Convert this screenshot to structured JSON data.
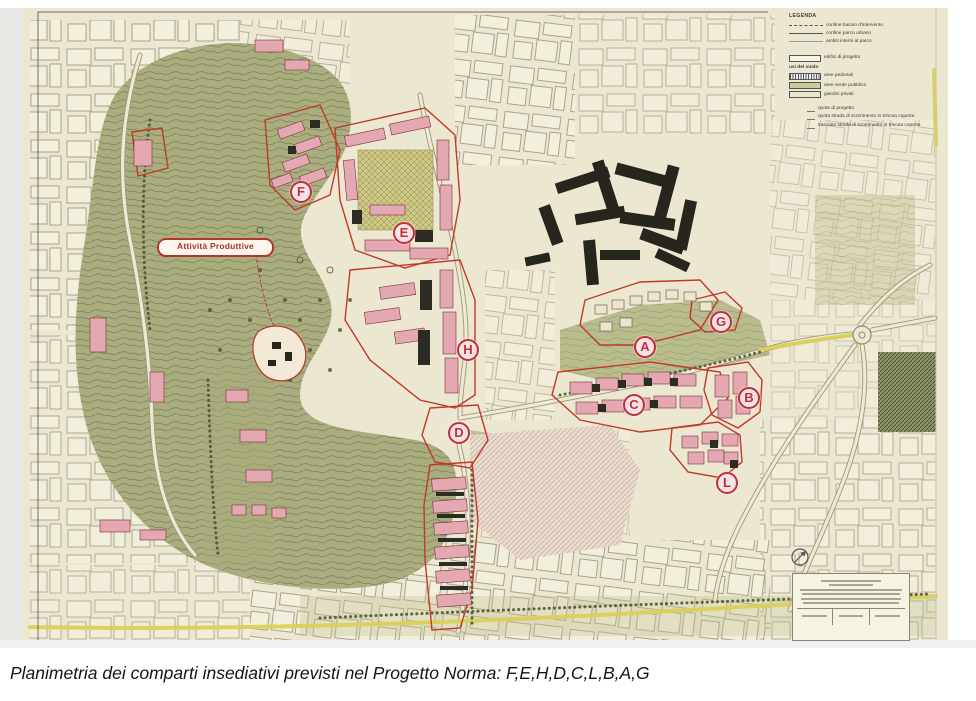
{
  "caption": "Planimetria dei comparti insediativi previsti nel Progetto Norma: F,E,H,D,C,L,B,A,G",
  "map": {
    "productive_area_label": "Attività Produttive",
    "markers": [
      {
        "letter": "F",
        "x": 301,
        "y": 192
      },
      {
        "letter": "E",
        "x": 404,
        "y": 233
      },
      {
        "letter": "H",
        "x": 468,
        "y": 350
      },
      {
        "letter": "D",
        "x": 459,
        "y": 433
      },
      {
        "letter": "A",
        "x": 645,
        "y": 347
      },
      {
        "letter": "G",
        "x": 721,
        "y": 322
      },
      {
        "letter": "C",
        "x": 634,
        "y": 405
      },
      {
        "letter": "B",
        "x": 749,
        "y": 398
      },
      {
        "letter": "L",
        "x": 727,
        "y": 483
      }
    ],
    "legend": {
      "title": "LEGENDA",
      "line_items": [
        "confine bacino d'intervento",
        "confine parco urbano",
        "ambiti interni al parco"
      ],
      "building_item": "edifici di progetto",
      "land_use_header": "usi del suolo",
      "land_use_items": [
        "aree pedonali",
        "aree verde pubblico",
        "giardini privati"
      ],
      "symbol_items": [
        "quote di progetto",
        "quota strada di scorrimento in trincea coperta",
        "tracciato strada di scorrimento in trincea coperta"
      ]
    }
  },
  "colors": {
    "page_bg": "#ffffff",
    "sheet_bg": "#ece7d1",
    "park_green": "#aaae7f",
    "field_green": "#b9bd8d",
    "building_pink": "#e3a8b1",
    "comparto_red": "#c0392b",
    "existing_dark": "#26261f",
    "road_yellow": "#d9d058",
    "marker_red": "#c0303a"
  }
}
